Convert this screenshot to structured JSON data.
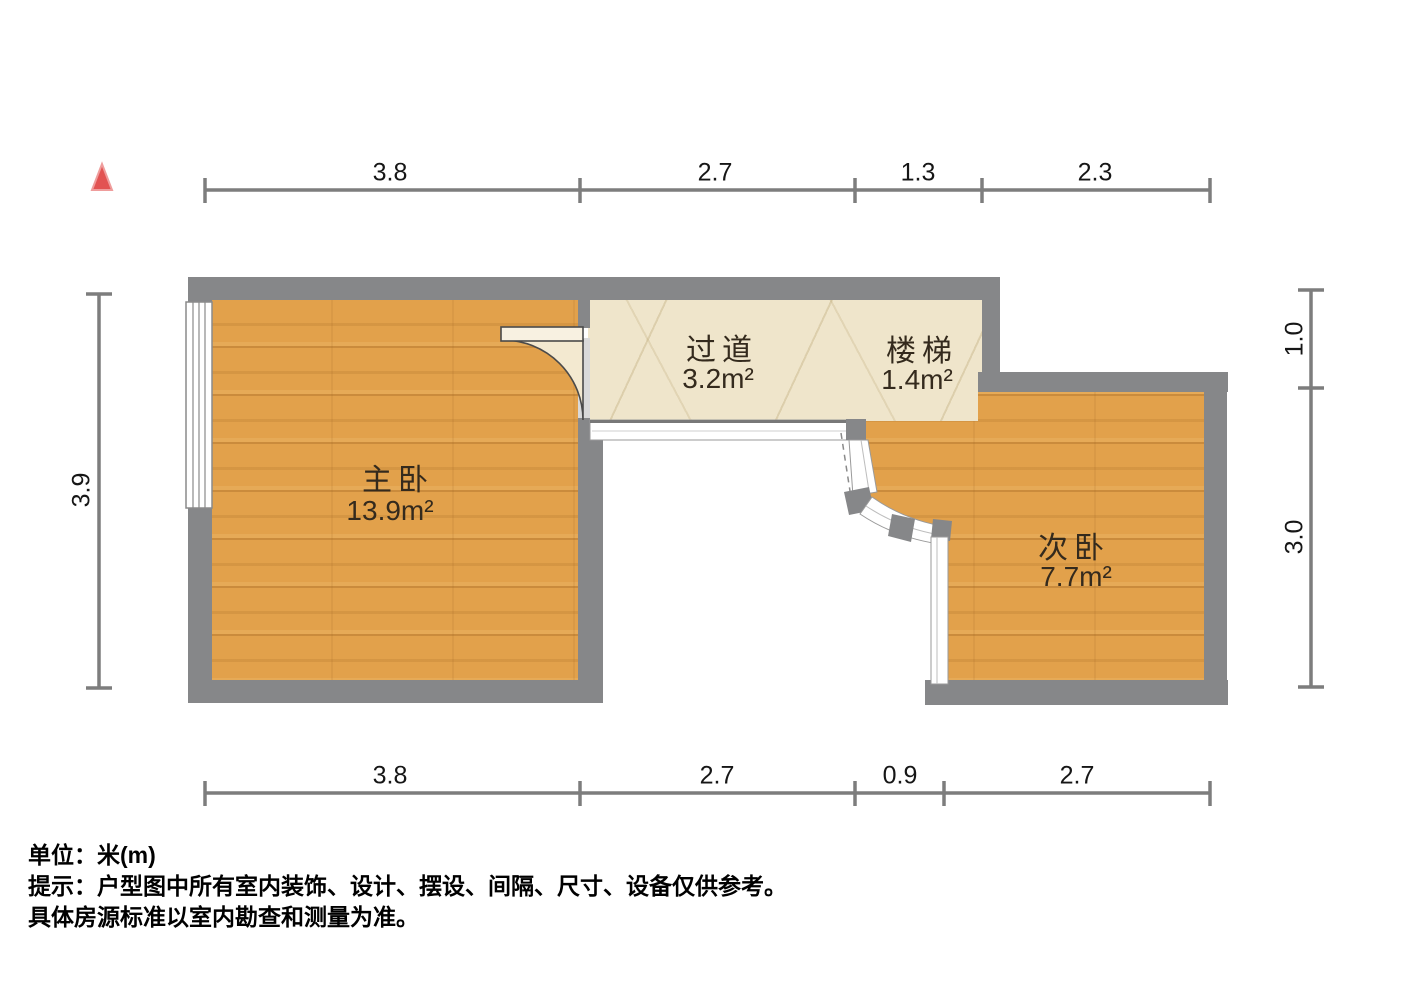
{
  "plan": {
    "title": "户型图",
    "north_indicator": "north-arrow",
    "rooms": [
      {
        "name": "主卧",
        "area": "13.9m²"
      },
      {
        "name": "过道",
        "area": "3.2m²"
      },
      {
        "name": "楼梯",
        "area": "1.4m²"
      },
      {
        "name": "次卧",
        "area": "7.7m²"
      }
    ],
    "dimensions_top": [
      "3.8",
      "2.7",
      "1.3",
      "2.3"
    ],
    "dimensions_bottom": [
      "3.8",
      "2.7",
      "0.9",
      "2.7"
    ],
    "dimensions_left": [
      "3.9"
    ],
    "dimensions_right": [
      "1.0",
      "3.0"
    ],
    "footer_lines": [
      "单位：米(m)",
      "提示：户型图中所有室内装饰、设计、摆设、间隔、尺寸、设备仅供参考。",
      "具体房源标准以室内勘查和测量为准。"
    ],
    "colors": {
      "wall": "#868789",
      "wood_floor": "#e2a14b",
      "tile_floor": "#efe5cb",
      "north_arrow": "#e25352",
      "dimension_line": "#7d7d7d",
      "door_swing": "#f3e9d0"
    }
  }
}
